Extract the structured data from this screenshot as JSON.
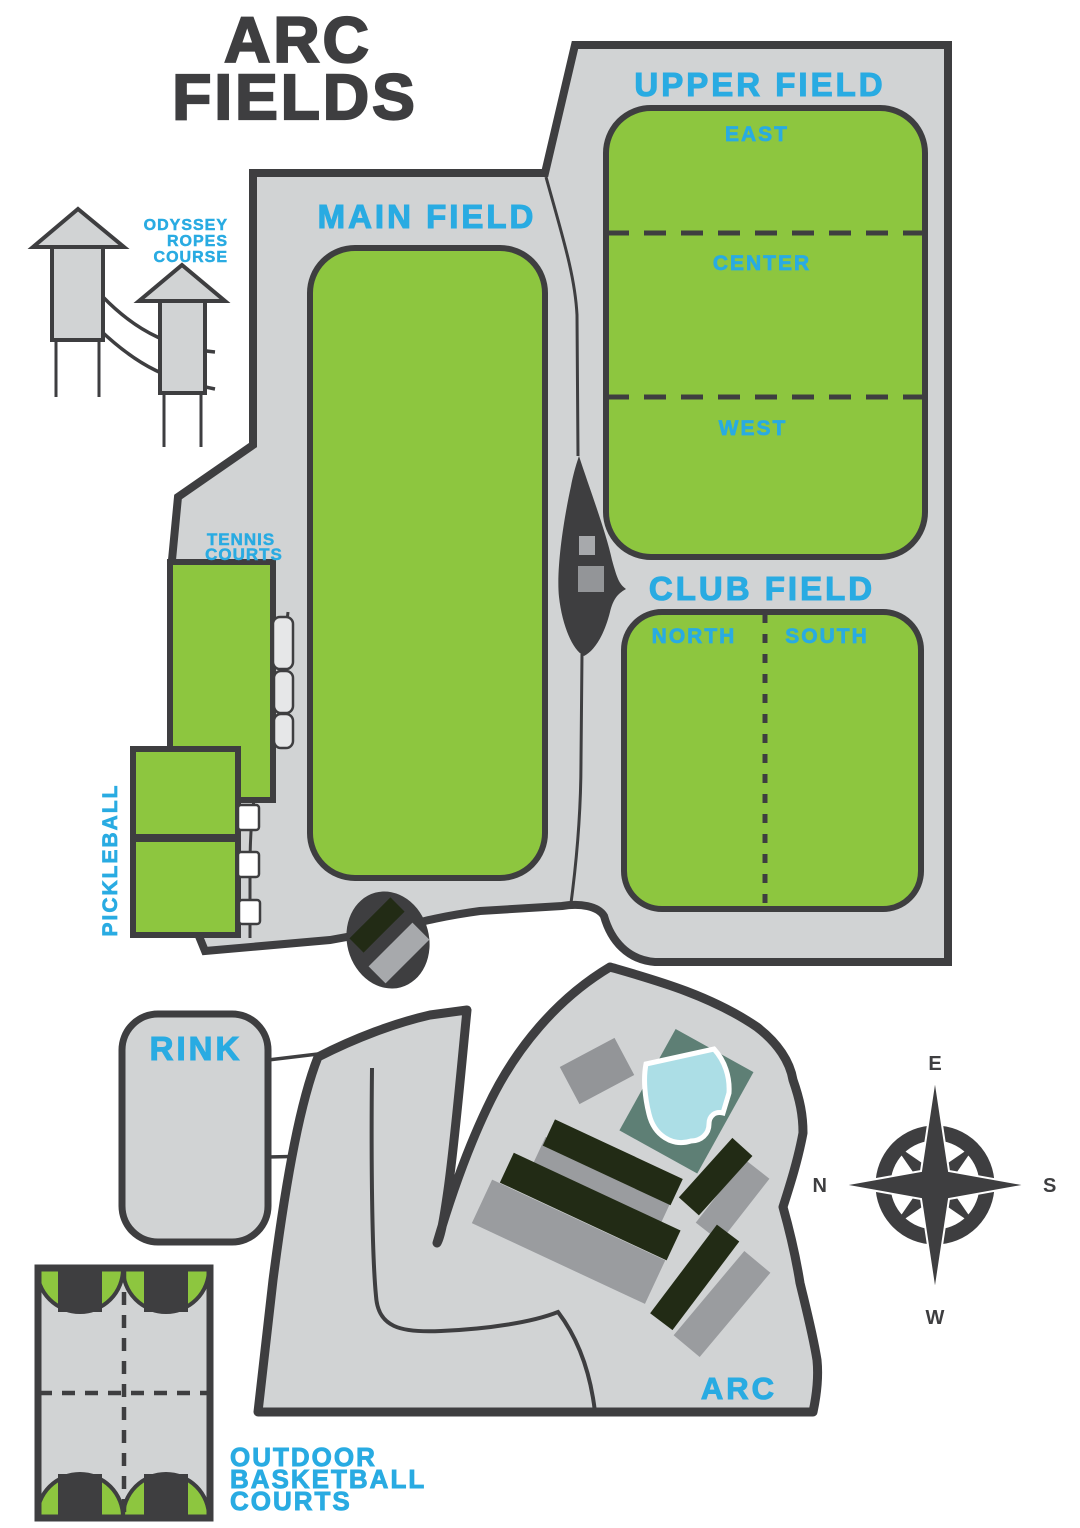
{
  "title": [
    "ARC",
    "FIELDS"
  ],
  "ropes_course": {
    "label_lines": [
      "ODYSSEY",
      "ROPES",
      "COURSE"
    ]
  },
  "fields": {
    "main": {
      "label": "MAIN FIELD"
    },
    "upper": {
      "label": "UPPER FIELD",
      "sections": [
        "EAST",
        "CENTER",
        "WEST"
      ]
    },
    "club": {
      "label": "CLUB FIELD",
      "sections": [
        "NORTH",
        "SOUTH"
      ]
    }
  },
  "courts": {
    "tennis_lines": [
      "TENNIS",
      "COURTS"
    ],
    "pickleball": "PICKLEBALL",
    "basketball_lines": [
      "OUTDOOR",
      "BASKETBALL",
      "COURTS"
    ]
  },
  "rink": {
    "label": "RINK"
  },
  "arc_building": {
    "label": "ARC"
  },
  "compass": {
    "top": "E",
    "right": "S",
    "bottom": "W",
    "left": "N"
  },
  "colors": {
    "field_green": "#8DC63F",
    "area_gray": "#D1D3D4",
    "outline_dark": "#3E3E40",
    "label_blue": "#29ABE2",
    "building_dark": "#222B15",
    "building_gray": "#9A9C9F",
    "pool_deck_teal": "#5E7F75",
    "pool_water": "#ACDEE6",
    "title_dark": "#3E3E40"
  }
}
